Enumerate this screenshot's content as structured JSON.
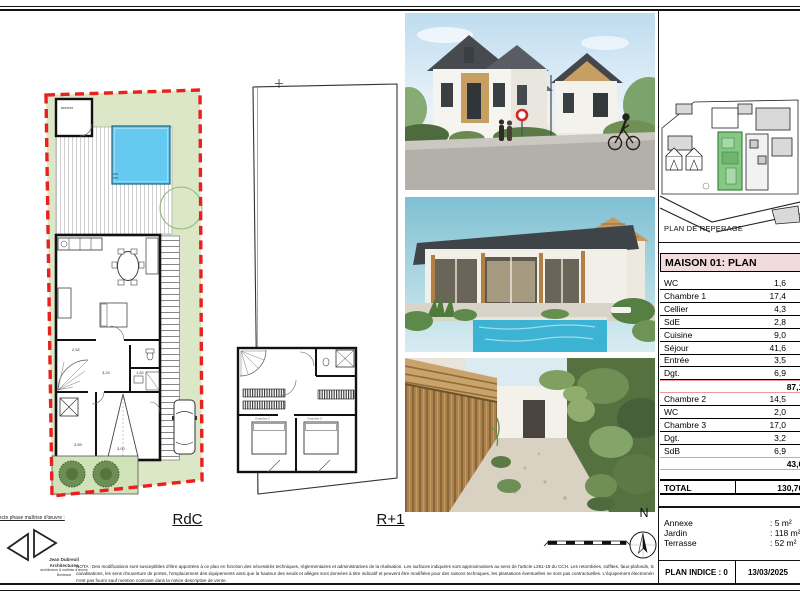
{
  "colors": {
    "boundary_red": "#e8211d",
    "garden_green": "#dbe7c6",
    "pool_blue": "#66c9f0",
    "table_header_bg": "#f2dcdb",
    "subtotal_line": "#ef9a9a",
    "map_highlight_green": "#86c786"
  },
  "plans": {
    "rdc_label": "RdC",
    "r1_label": "R+1",
    "north_label": "N",
    "annexe_plan_label": "Annexe",
    "rdc_dims": [
      "2,52",
      "3,24",
      "1,62",
      "3,59",
      "3,00"
    ],
    "r1_rooms": [
      "Chambre 2",
      "Chambre 3"
    ]
  },
  "map": {
    "label": "PLAN DE REPERAGE"
  },
  "table": {
    "title": "MAISON 01: PLAN",
    "rows": [
      {
        "label": "WC",
        "value": "1,6"
      },
      {
        "label": "Chambre 1",
        "value": "17,4"
      },
      {
        "label": "Cellier",
        "value": "4,3"
      },
      {
        "label": "SdE",
        "value": "2,8"
      },
      {
        "label": "Cuisine",
        "value": "9,0"
      },
      {
        "label": "Séjour",
        "value": "41,6"
      },
      {
        "label": "Entrée",
        "value": "3,5"
      },
      {
        "label": "Dgt.",
        "value": "6,9"
      },
      {
        "label": "",
        "value": "87,1 m²"
      },
      {
        "label": "Chambre 2",
        "value": "14,5"
      },
      {
        "label": "WC",
        "value": "2,0"
      },
      {
        "label": "Chambre 3",
        "value": "17,0"
      },
      {
        "label": "Dgt.",
        "value": "3,2"
      },
      {
        "label": "SdB",
        "value": "6,9"
      },
      {
        "label": "",
        "value": "43,6 m²"
      }
    ],
    "total_label": "TOTAL",
    "total_value": "130,70 m²"
  },
  "summary": {
    "items": [
      {
        "label": "Annexe",
        "value": ": 5 m²"
      },
      {
        "label": "Jardin",
        "value": ": 118 m²"
      },
      {
        "label": "Terrasse",
        "value": ": 52 m²"
      }
    ],
    "indice": "PLAN INDICE : 0",
    "date": "13/03/2025"
  },
  "titleblock": {
    "phase": "Architecte phase maîtrise d'œuvre :",
    "architect_line1": "Jean Dubreuil",
    "architect_line2": "Architectures",
    "architect_line3": "architecture & maîtrise d'œuvre",
    "architect_line4": "Bordeaux",
    "nota_line1": "NOTA : Des modifications sont susceptibles d'être apportées à ce plan en fonction des nécessités techniques, réglementaires et administratives de la réalisation. Les surfaces indiquées sont approximatives au sens de l'article L261-15 du CCH. Les retombées, soffites, faux-plafonds, trappes de visite,",
    "nota_line2": "canalisations, les sens d'ouverture de portes, l'emplacement des équipements ainsi que la hauteur des seuils et allèges sont données à titre indicatif et peuvent être modifiées pour des raisons techniques, les plantations éventuelles ne sont pas contractuelles. L'équipement électroménager et mobilier indiqué sur plan",
    "nota_line3": "n'est pas fourni sauf mention contraire dans la notice descriptive de vente."
  }
}
